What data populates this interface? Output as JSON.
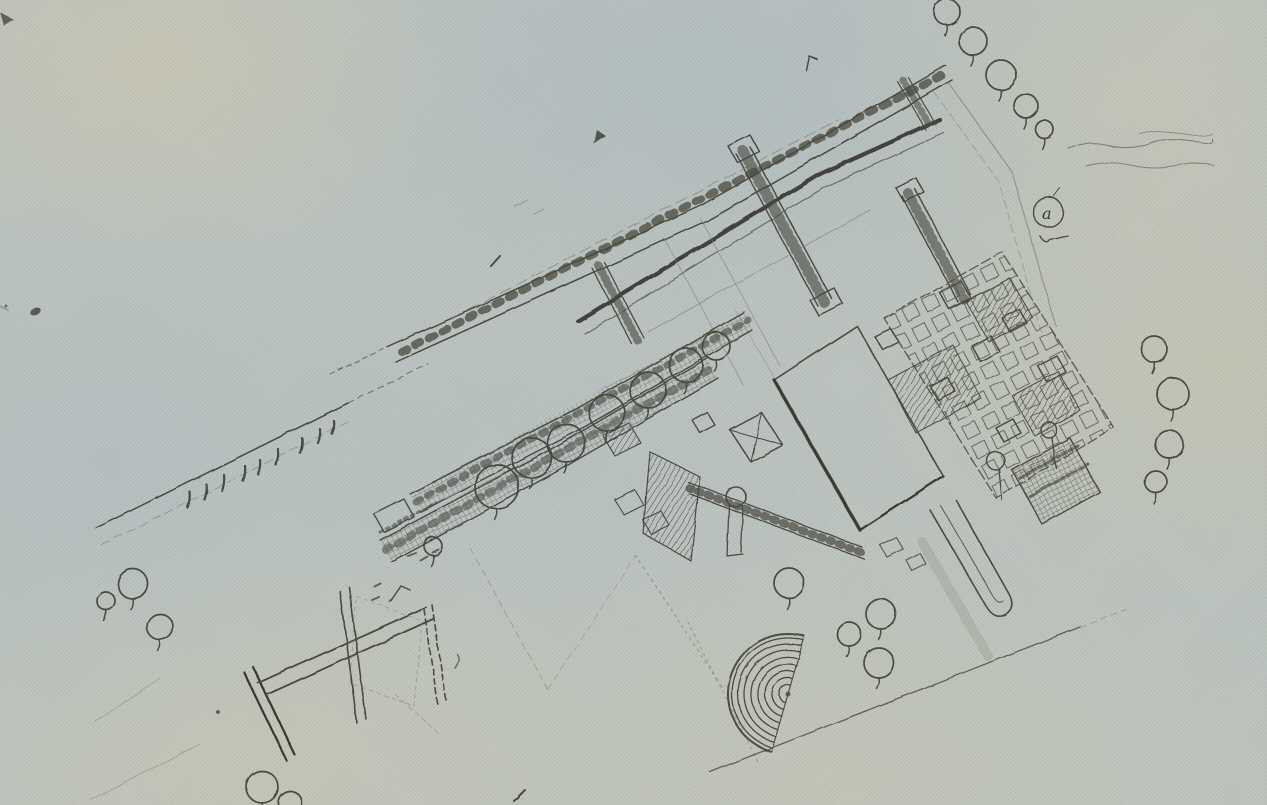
{
  "annotations": {
    "tree_label": "a"
  },
  "palette": {
    "paper": "#c2c8c4",
    "paper_blue": "#b4c1c8",
    "paper_beige": "#d6cfb2",
    "ink": "#46443a",
    "ink_dark": "#33312a",
    "ink_faint": "#80816f"
  },
  "trees": [
    [
      947,
      12,
      13
    ],
    [
      973,
      41,
      14
    ],
    [
      1001,
      75,
      15
    ],
    [
      1026,
      106,
      12
    ],
    [
      1044,
      129,
      9
    ],
    [
      1154,
      349,
      13
    ],
    [
      1173,
      394,
      16
    ],
    [
      1169,
      444,
      14
    ],
    [
      1156,
      482,
      11
    ],
    [
      497,
      487,
      22
    ],
    [
      532,
      458,
      20
    ],
    [
      566,
      443,
      19
    ],
    [
      607,
      413,
      18
    ],
    [
      648,
      390,
      18
    ],
    [
      686,
      365,
      17
    ],
    [
      716,
      346,
      14
    ],
    [
      433,
      546,
      9
    ],
    [
      789,
      583,
      15
    ],
    [
      881,
      614,
      15
    ],
    [
      849,
      634,
      12
    ],
    [
      879,
      663,
      15
    ],
    [
      106,
      601,
      9
    ],
    [
      133,
      584,
      15
    ],
    [
      160,
      627,
      13
    ],
    [
      262,
      787,
      16
    ],
    [
      290,
      803,
      12
    ]
  ],
  "amphitheater": {
    "cx": 788,
    "cy": 694,
    "radii": [
      9,
      16,
      23,
      30,
      37,
      44,
      50,
      56
    ],
    "rim_radius": 60,
    "rotation_deg": 16
  }
}
